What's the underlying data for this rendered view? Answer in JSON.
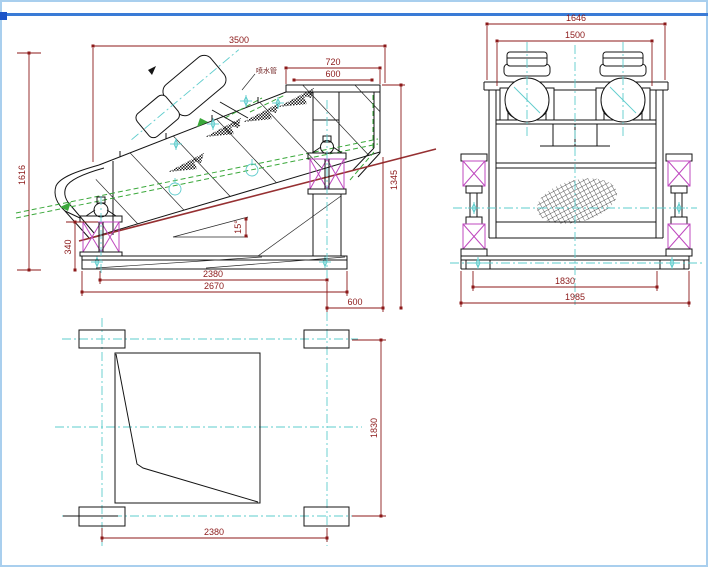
{
  "drawing_type": "engineering-three-view-cad-drawing",
  "colors": {
    "dimension": "#8c1a1a",
    "outline": "#141414",
    "centerline": "#5ecccc",
    "pipe_green": "#3aa83a",
    "spring_magenta": "#bf49bf",
    "deck_red": "#963032",
    "frame_border": "#a9cfee",
    "frame_topline": "#3a7bd6",
    "frame_topblock": "#1c55c8",
    "background": "#ffffff"
  },
  "side_view": {
    "dim_overall_length": "3500",
    "dim_top_width": "720",
    "dim_top_inner_width": "600",
    "dim_total_height": "1616",
    "dim_front_height": "340",
    "dim_right_height": "1345",
    "dim_base_span": "2380",
    "dim_base_overall": "2670",
    "dim_discharge_offset": "600",
    "dim_incline_angle": "15°",
    "label_spray_pipe": "喷水管"
  },
  "front_view": {
    "dim_overall_width": "1646",
    "dim_motor_span": "1500",
    "dim_foot_span": "1830",
    "dim_base_width": "1985"
  },
  "plan_view": {
    "dim_length": "2380",
    "dim_width": "1830"
  }
}
